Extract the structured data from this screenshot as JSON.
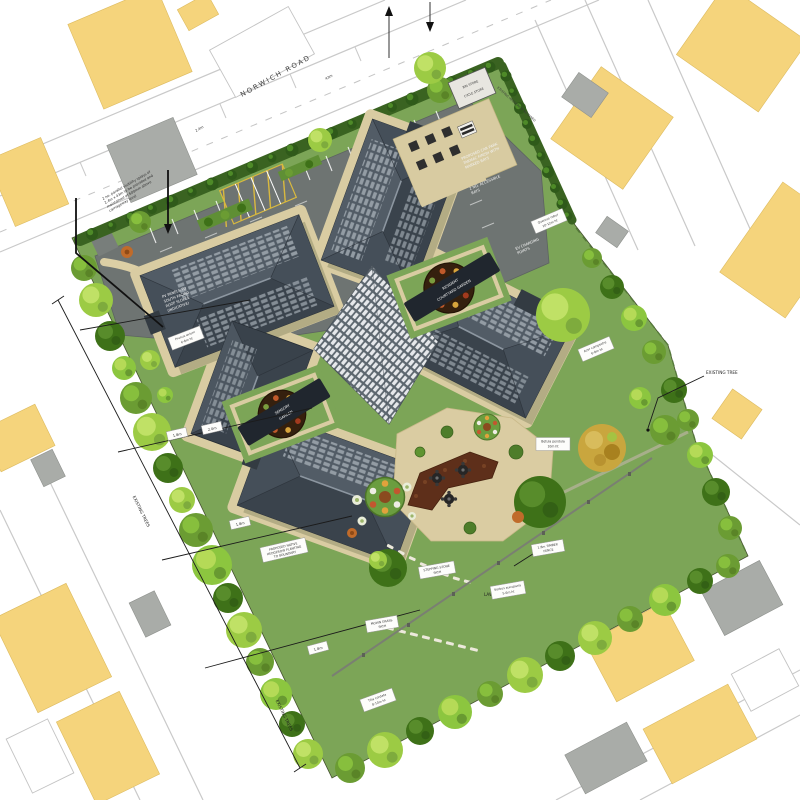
{
  "plan": {
    "road": "NORWICH ROAD",
    "visibility": [
      "2 no. parallel visibility splays of",
      "2.4m x 43m to be provided and",
      "maintained at 600mm above",
      "carriageway level"
    ],
    "splay_dims": {
      "a": "2.4m",
      "b": "43m"
    },
    "boundary": {
      "left_trees": "EXISTING TREES",
      "left_trees2": "EXISTING TREES",
      "right_tree": "EXISTING TREE",
      "hedge_right": "EXISTING HEDGEROW RETAINED"
    },
    "hedge_note": [
      "PROPOSED NATIVE",
      "HEDGEROW PLANTING",
      "TO BOUNDARY"
    ],
    "dims": {
      "d1": "1.8m",
      "d2": "2.0m",
      "d3": "1.8m",
      "d4": "1.8m"
    },
    "roof_note": [
      "PV PANELS TO",
      "SOUTH FACING",
      "ROOF SLOPES",
      "(INDICATIVE)"
    ],
    "courtyards": {
      "ne": {
        "l1": "RESIDENT",
        "l2": "COURTYARD GARDEN"
      },
      "sw": {
        "l1": "SENSORY",
        "l2": "GARDEN"
      }
    },
    "carpark": {
      "note1": [
        "PROPOSED CAR PARK",
        "TARMAC FINISH WITH",
        "MARKED BAYS"
      ],
      "note2": [
        "2 NO. ACCESSIBLE",
        "BAYS"
      ],
      "ev": [
        "EV CHARGING",
        "POINTS"
      ],
      "bin": "BIN STORE",
      "cycle": "CYCLE STORE"
    },
    "garden": {
      "lawn": "LAWN",
      "path": [
        "STEPPING STONE",
        "PATH"
      ],
      "mown": [
        "MOWN GRASS",
        "PATH"
      ],
      "fence": [
        "1.8m TIMBER",
        "FENCE"
      ]
    },
    "tags": [
      {
        "l1": "Quercus robur",
        "l2": "10-12m ht"
      },
      {
        "l1": "Acer campestre",
        "l2": "6-8m ht"
      },
      {
        "l1": "Betula pendula",
        "l2": "10m ht"
      },
      {
        "l1": "Prunus avium",
        "l2": "6-8m ht"
      },
      {
        "l1": "Sorbus aucuparia",
        "l2": "5-6m ht"
      },
      {
        "l1": "Tilia cordata",
        "l2": "8-10m ht"
      }
    ],
    "colors": {
      "site_green": "#7CA557",
      "asphalt": "#6E7472",
      "path_buff": "#D9CCA2",
      "roof_dark": "#39424B",
      "roof_light": "#525C66",
      "context_yellow": "#F5D47C",
      "context_gray": "#A9ACA8"
    }
  }
}
